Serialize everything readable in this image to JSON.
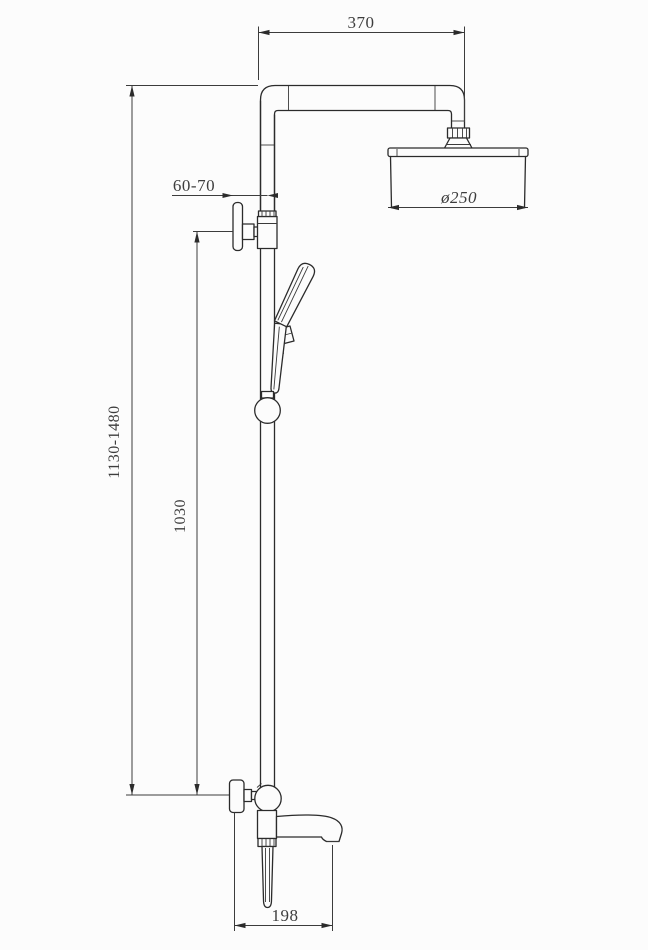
{
  "meta": {
    "drawing_type": "shower-column-technical-drawing",
    "background_color": "#fcfcfc",
    "line_color": "#2b2b2b",
    "text_color": "#3d3d3d"
  },
  "dimensions": {
    "arm_width": "370",
    "head_diameter": "ø250",
    "wall_offset": "60-70",
    "bar_height": "1030",
    "overall_height": "1130-1480",
    "spout_reach": "198"
  }
}
